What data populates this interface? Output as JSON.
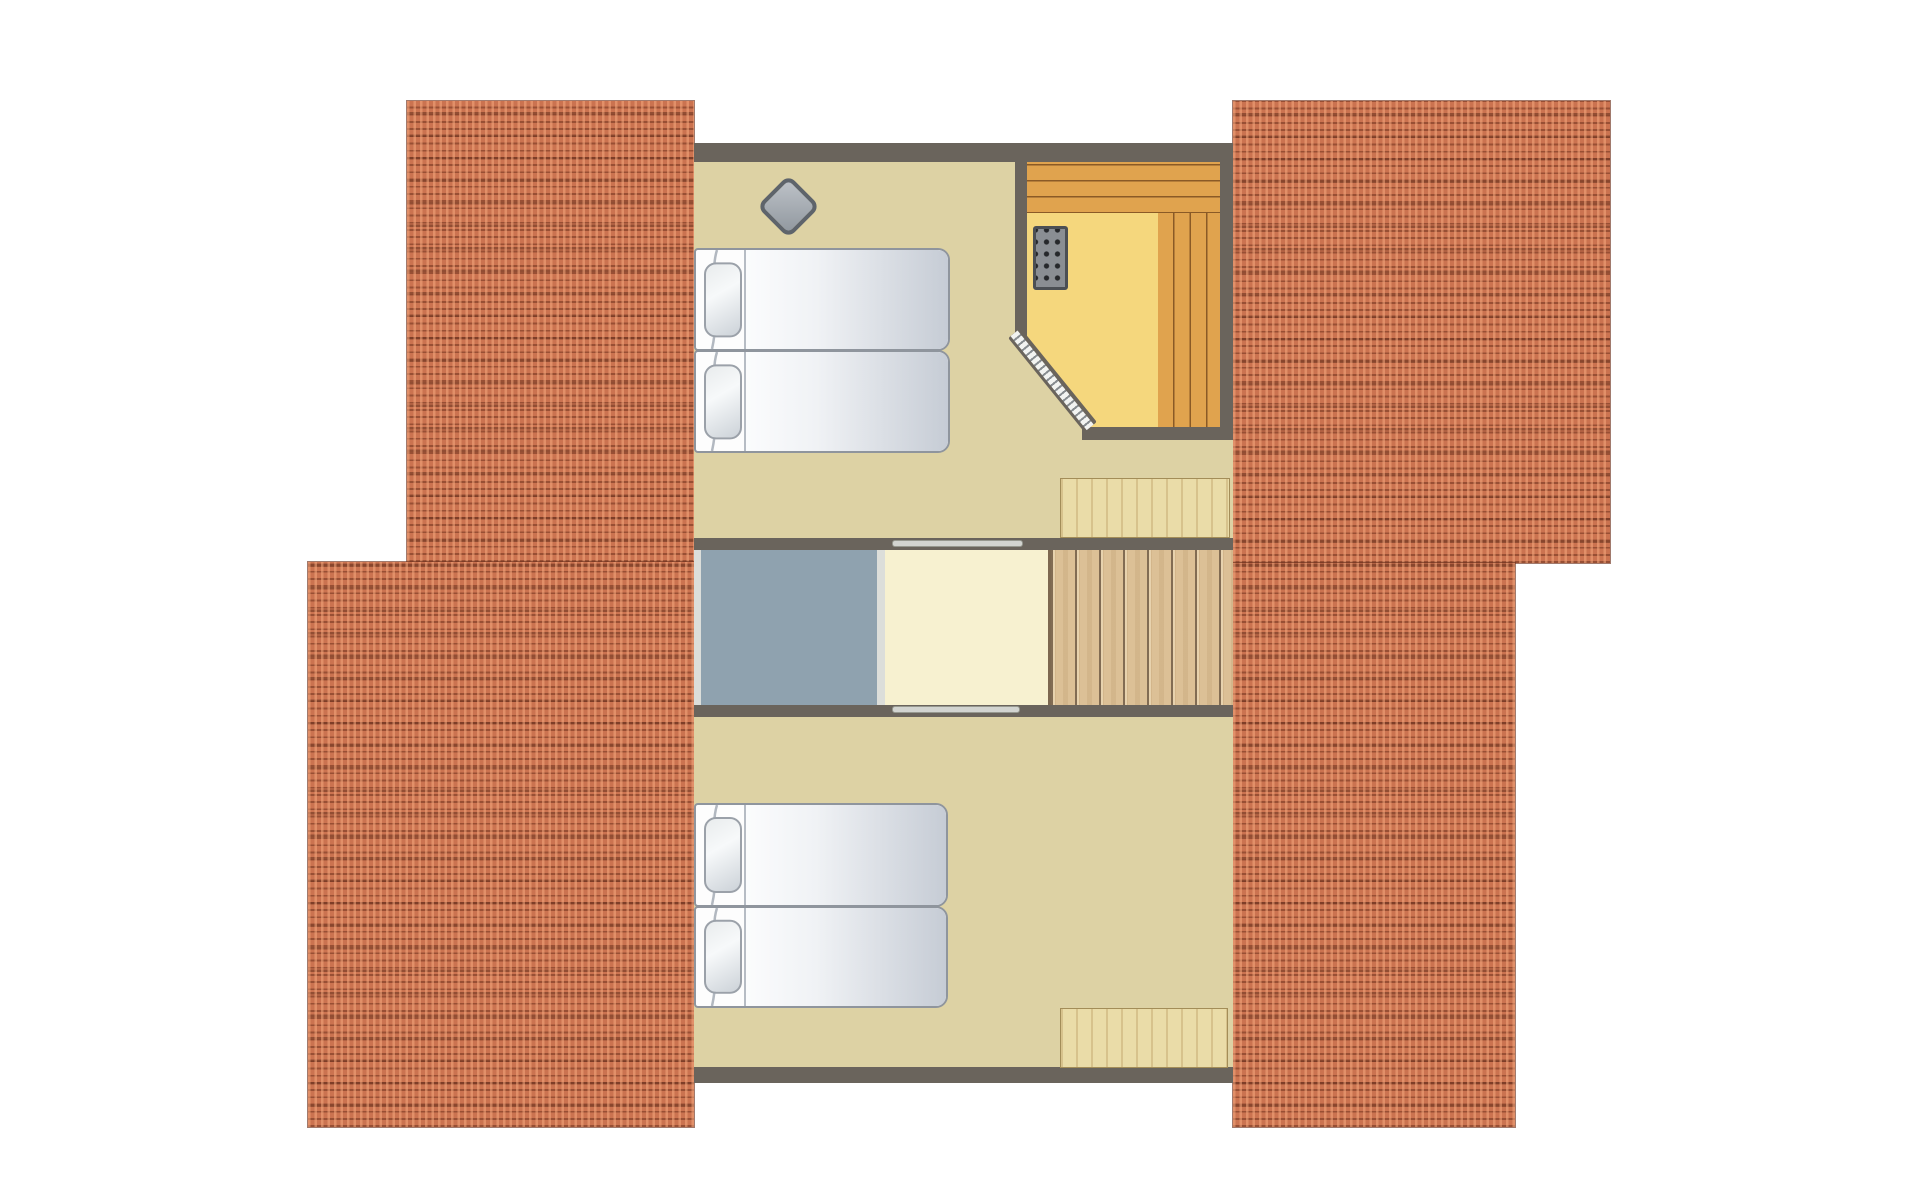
{
  "meta": {
    "type": "architectural-floor-plan",
    "view": "top-down",
    "level": "attic-floor",
    "visible_text": "none"
  },
  "colors": {
    "background": "#ffffff",
    "wall": "#6a645c",
    "roof_base": "#cb7350",
    "roof_dot_light": "rgba(245,168,126,0.55)",
    "roof_line_fine": "rgba(110,50,30,0.55)",
    "roof_line_coarse": "rgba(90,40,22,0.5)",
    "floor_beige": "#ddd2a4",
    "sauna_floor": "#f5d77d",
    "bench_wood": "#e0a34e",
    "bench_line": "#8a5a26",
    "stairs_wood": "#dcc096",
    "stairs_line": "#7d6850",
    "landing_cream": "#f7f1d0",
    "void_gray": "#8fa2af",
    "divider_light": "#dcdeda",
    "door_leaf": "#d2d4d0",
    "dresser_wood": "#eadca8",
    "dresser_border": "#a38d58",
    "bed_border": "#8f959d",
    "bed_white": "#fdfdfd",
    "duvet_shadow": "#c6ccd5",
    "pillow_border": "#9ba1a9",
    "stove_border": "#5e646b",
    "stove_fill_a": "#b9bec4",
    "stove_fill_b": "#939aa1",
    "heater_body": "#8a8e93",
    "heater_border": "#4b4f54",
    "heater_dot": "#26282b",
    "door_stripe_dark": "#878c90"
  },
  "structure": {
    "roof_sections": [
      {
        "id": "roof-left-top",
        "side": "left",
        "position": "upper"
      },
      {
        "id": "roof-left-bottom",
        "side": "left",
        "position": "lower"
      },
      {
        "id": "roof-right-top",
        "side": "right",
        "position": "upper"
      },
      {
        "id": "roof-right-bottom",
        "side": "right",
        "position": "lower"
      }
    ],
    "rooms": [
      {
        "id": "bedroom-top",
        "furniture": [
          "single-bed",
          "single-bed",
          "wood-stove"
        ]
      },
      {
        "id": "sauna",
        "furniture": [
          "bench-top",
          "bench-right",
          "sauna-heater",
          "glass-door-diagonal"
        ]
      },
      {
        "id": "landing",
        "furniture": [
          "sliding-door-top",
          "sliding-door-bottom"
        ]
      },
      {
        "id": "void-opening",
        "furniture": []
      },
      {
        "id": "staircase",
        "tread_lines": 8,
        "direction": "descending-right"
      },
      {
        "id": "bedroom-bottom",
        "furniture": [
          "single-bed",
          "single-bed",
          "dresser"
        ]
      }
    ],
    "counts": {
      "beds": 4,
      "pillows": 4,
      "dressers": 2,
      "doors": 3,
      "heaters": 1,
      "stoves": 1
    }
  }
}
